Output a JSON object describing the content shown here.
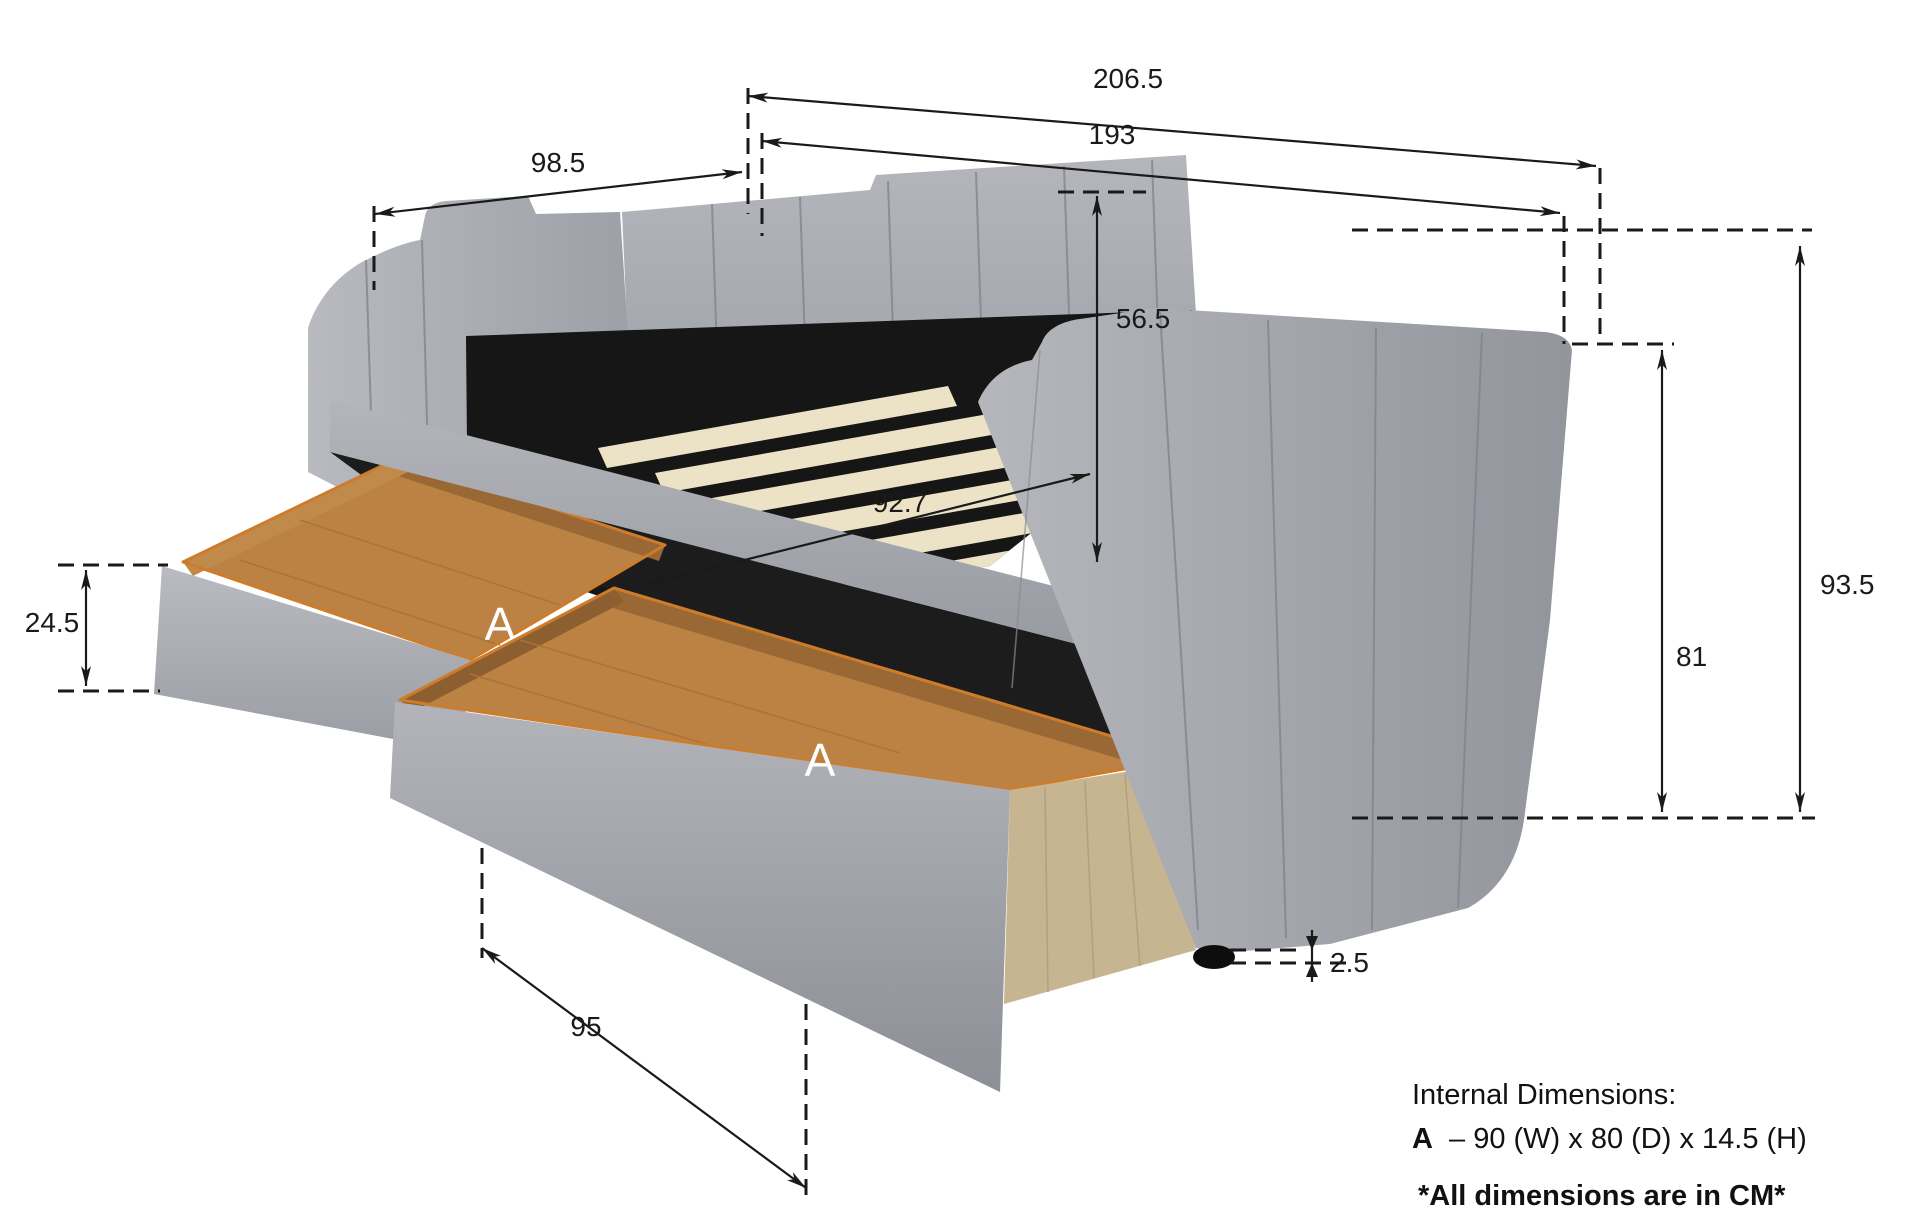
{
  "dimensions": {
    "overall_length": "206.5",
    "inner_length": "193",
    "depth": "98.5",
    "backrest_height": "56.5",
    "slat_width": "92.7",
    "overall_height": "93.5",
    "arm_height": "81",
    "drawer_height": "24.5",
    "drawer_front_length": "95",
    "foot_height": "2.5"
  },
  "drawer_labels": {
    "first": "A",
    "second": "A"
  },
  "notes": {
    "title": "Internal Dimensions:",
    "item_label": "A",
    "item_value": "–  90 (W) x 80 (D) x 14.5 (H)",
    "units": "*All dimensions are in CM*"
  },
  "colors": {
    "fabric": "#aeb0b6",
    "fabric_dark": "#8f9197",
    "shadow": "#161616",
    "under_shadow": "#1c1c1c",
    "slat": "#ece3c6",
    "wood_interior": "#bc8244",
    "wood_wall": "#9a6834",
    "wood_wall_light": "#c08a4a",
    "wood_rim": "#cd7c2c",
    "oak_side": "#c7b591",
    "foot": "#0d0d0d",
    "dimension_line": "#1a1a1a",
    "label_white": "#ffffff",
    "background": "#ffffff"
  }
}
